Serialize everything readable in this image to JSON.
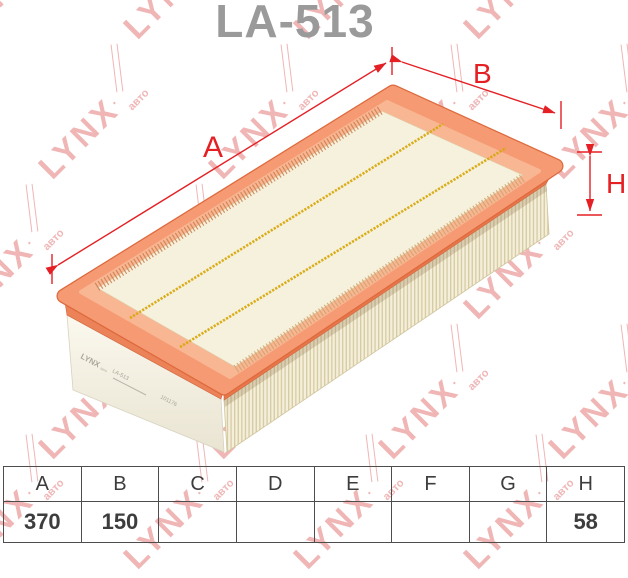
{
  "title": "LA-513",
  "watermark": {
    "brand": "LYNX",
    "sub": "авто",
    "dot": ".",
    "color": "#e47878"
  },
  "dimensions": {
    "length_label": "A",
    "width_label": "B",
    "height_label": "H",
    "color": "#e42025"
  },
  "side_print": {
    "brand": "LYNX",
    "brand_sub": "авто",
    "part": "LA-513",
    "code": "101176"
  },
  "product": {
    "frame_color": "#f59a72",
    "media_color": "#f6f1dc",
    "glue_color": "#d8a90e"
  },
  "table": {
    "headers": [
      "A",
      "B",
      "C",
      "D",
      "E",
      "F",
      "G",
      "H"
    ],
    "values": [
      "370",
      "150",
      "",
      "",
      "",
      "",
      "",
      "58"
    ]
  }
}
